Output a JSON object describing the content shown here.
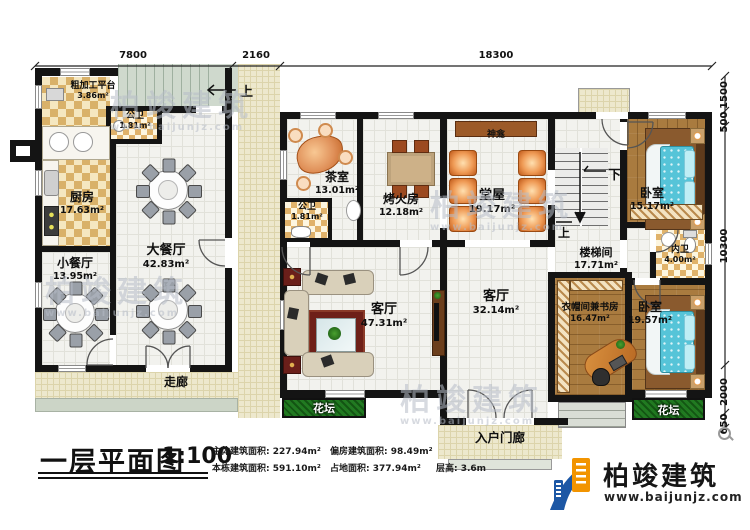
{
  "title": {
    "text": "一层平面图",
    "scale": "1:100"
  },
  "stats": {
    "main_area": "主体建筑面积: 227.94m²",
    "side_area": "偏房建筑面积: 98.49m²",
    "total_area": "本栋建筑面积: 591.10m²",
    "footprint": "占地面积: 377.94m²",
    "floor_height": "层高: 3.6m"
  },
  "logo": {
    "company": "柏竣建筑",
    "website": "www.baijunjz.com"
  },
  "watermark": {
    "text": "柏竣建筑",
    "website": "www.baijunjz.com"
  },
  "dims": {
    "top": [
      "7800",
      "2160",
      "18300"
    ],
    "right": [
      "1500",
      "500",
      "10300",
      "2000",
      "650"
    ]
  },
  "stairs": {
    "up": "上",
    "down": "下"
  },
  "rooms": {
    "rough_platform": {
      "name": "粗加工平台",
      "area": "3.86m²"
    },
    "kitchen": {
      "name": "厨房",
      "area": "17.63m²"
    },
    "wc_left": {
      "name": "公卫",
      "area": "1.81m²"
    },
    "dining_large": {
      "name": "大餐厅",
      "area": "42.83m²"
    },
    "dining_small": {
      "name": "小餐厅",
      "area": "13.95m²"
    },
    "corridor": {
      "name": "走廊"
    },
    "tea_room": {
      "name": "茶室",
      "area": "13.01m²"
    },
    "wc_main": {
      "name": "公卫",
      "area": "1.81m²"
    },
    "fire_room": {
      "name": "烤火房",
      "area": "12.18m²"
    },
    "hall": {
      "name": "堂屋",
      "area": "19.17m²"
    },
    "shrine": {
      "name": "神龛"
    },
    "stair_room": {
      "name": "楼梯间",
      "area": "17.71m²"
    },
    "bedroom_ne": {
      "name": "卧室",
      "area": "15.17m²"
    },
    "wc_inner": {
      "name": "内卫",
      "area": "4.00m²"
    },
    "cloak_study": {
      "name": "衣帽间兼书房",
      "area": "16.47m²"
    },
    "bedroom_se": {
      "name": "卧室",
      "area": "19.57m²"
    },
    "living_main": {
      "name": "客厅",
      "area": "47.31m²"
    },
    "living_second": {
      "name": "客厅",
      "area": "32.14m²"
    },
    "flowerbed_left": {
      "name": "花坛"
    },
    "flowerbed_right": {
      "name": "花坛"
    },
    "porch": {
      "name": "入户门廊"
    }
  }
}
